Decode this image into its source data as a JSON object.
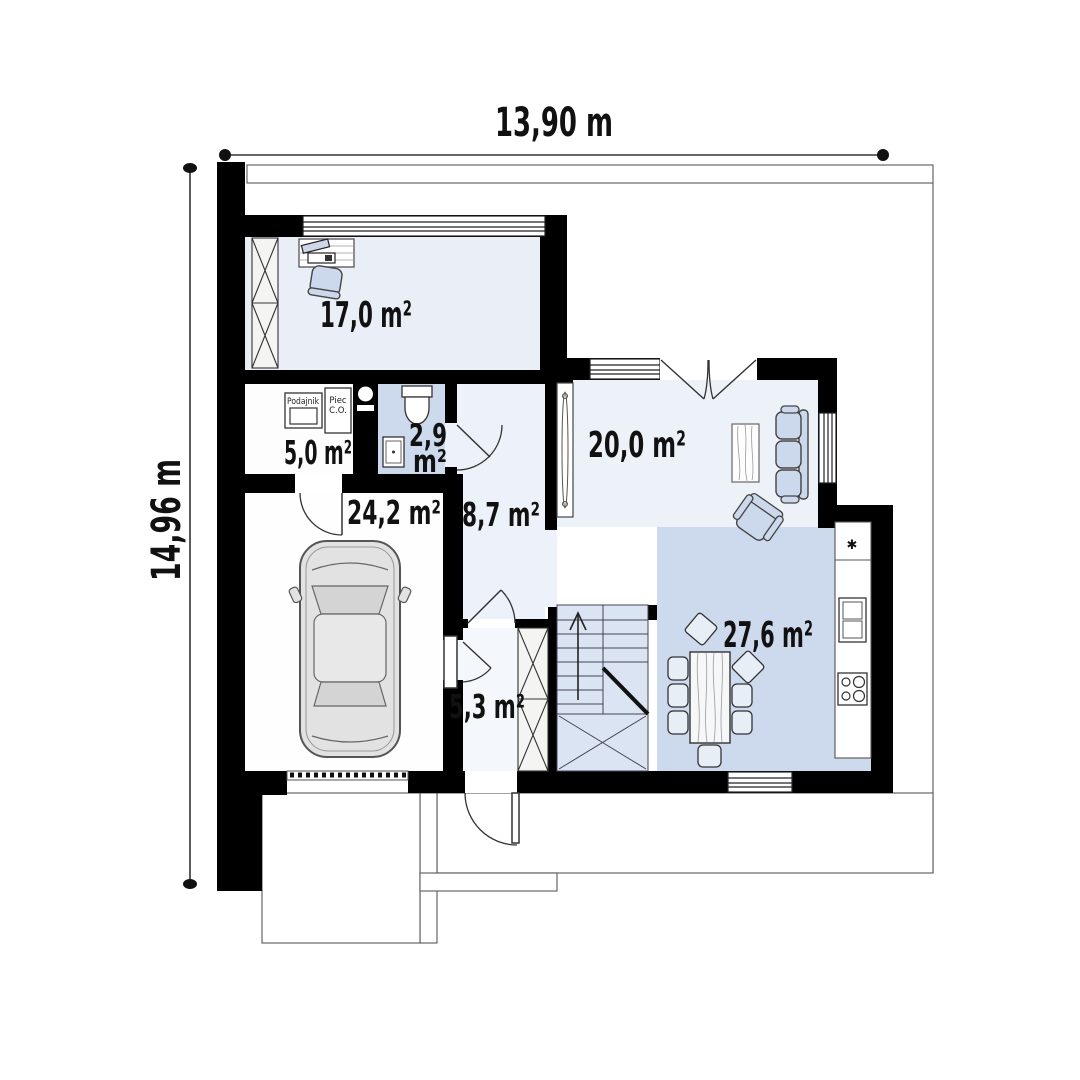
{
  "plan": {
    "dimensions": {
      "width_label": "13,90 m",
      "height_label": "14,96 m"
    },
    "rooms": {
      "office": {
        "area": "17,0 m²"
      },
      "boiler_room": {
        "area": "5,0 m²"
      },
      "bathroom": {
        "area_value": "2,9",
        "area_unit": "m²"
      },
      "garage": {
        "area": "24,2 m²"
      },
      "hall": {
        "area": "8,7 m²"
      },
      "living_room": {
        "area": "20,0 m²"
      },
      "vestibule": {
        "area": "5,3 m²"
      },
      "dining_kitchen": {
        "area": "27,6 m²"
      }
    },
    "equipment": {
      "feeder_label": "Podajnik",
      "boiler_label_line1": "Piec",
      "boiler_label_line2": "C.O.",
      "kitchen_star": "✱"
    },
    "colors": {
      "wall": "#000000",
      "room_pale": "#ecf1f8",
      "room_blue": "#cdd9ec",
      "stairs_blue": "#dbe4f2",
      "furniture_blue": "#ccd9ec"
    }
  }
}
